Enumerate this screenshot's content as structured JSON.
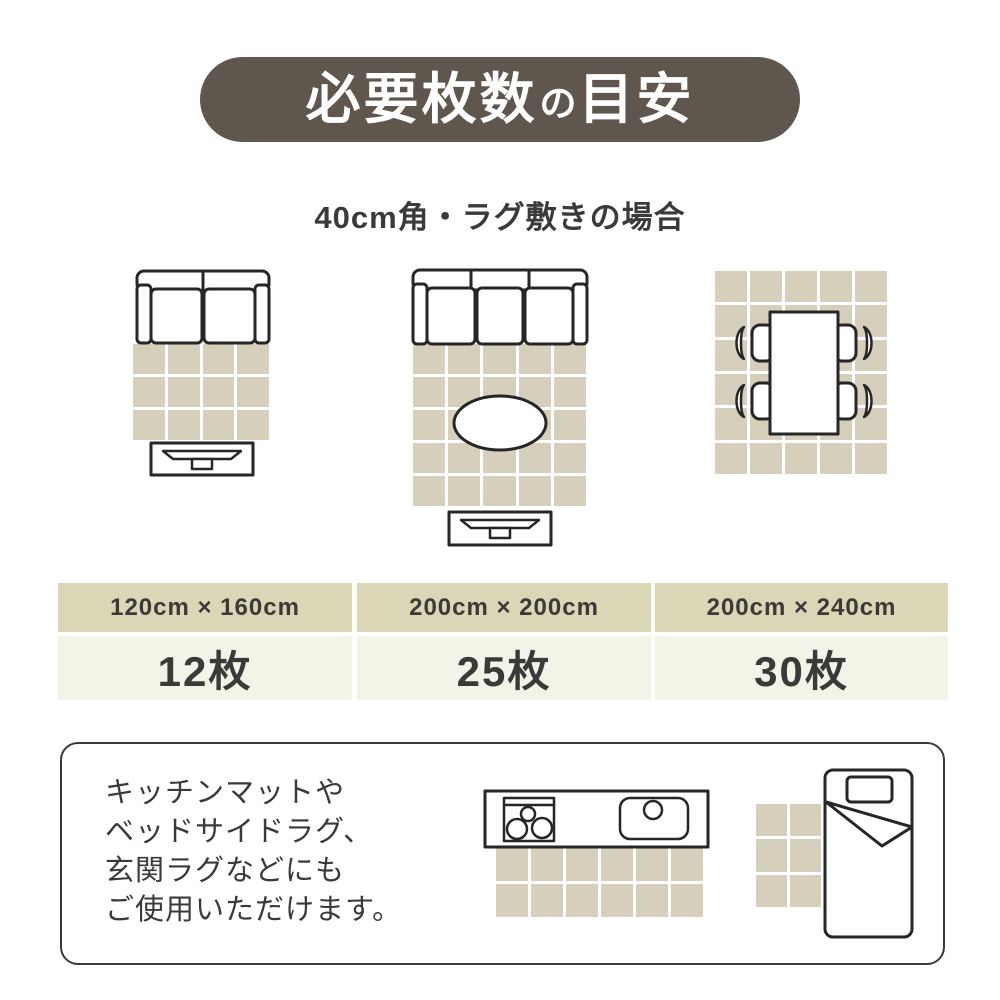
{
  "header": {
    "title_left": "必要枚数",
    "title_particle": "の",
    "title_right": "目安"
  },
  "subtitle": "40cm角・ラグ敷きの場合",
  "tile_size": "40cm角",
  "columns": [
    {
      "size": "120cm × 160cm",
      "count": "12枚",
      "grid": {
        "cols": 4,
        "rows": 3
      },
      "scene": "2-seat sofa with rug and TV stand"
    },
    {
      "size": "200cm × 200cm",
      "count": "25枚",
      "grid": {
        "cols": 5,
        "rows": 5
      },
      "scene": "3-seat sofa with oval table, rug and TV stand"
    },
    {
      "size": "200cm × 240cm",
      "count": "30枚",
      "grid": {
        "cols": 5,
        "rows": 6
      },
      "scene": "dining table with four chairs on rug"
    }
  ],
  "note": {
    "lines": [
      "キッチンマットや",
      "ベッドサイドラグ、",
      "玄関ラグなどにも",
      "ご使用いただけます。"
    ]
  },
  "extras": {
    "kitchen_mat_grid": {
      "cols": 6,
      "rows": 2
    },
    "bedside_rug_grid": {
      "cols": 2,
      "rows": 3
    }
  },
  "colors": {
    "header_bg": "#5F564D",
    "tile": "#D6CFBC",
    "band": "#DBD6B5",
    "band_light": "#F4F3E8",
    "ink": "#3B3A39",
    "line": "#262626"
  }
}
